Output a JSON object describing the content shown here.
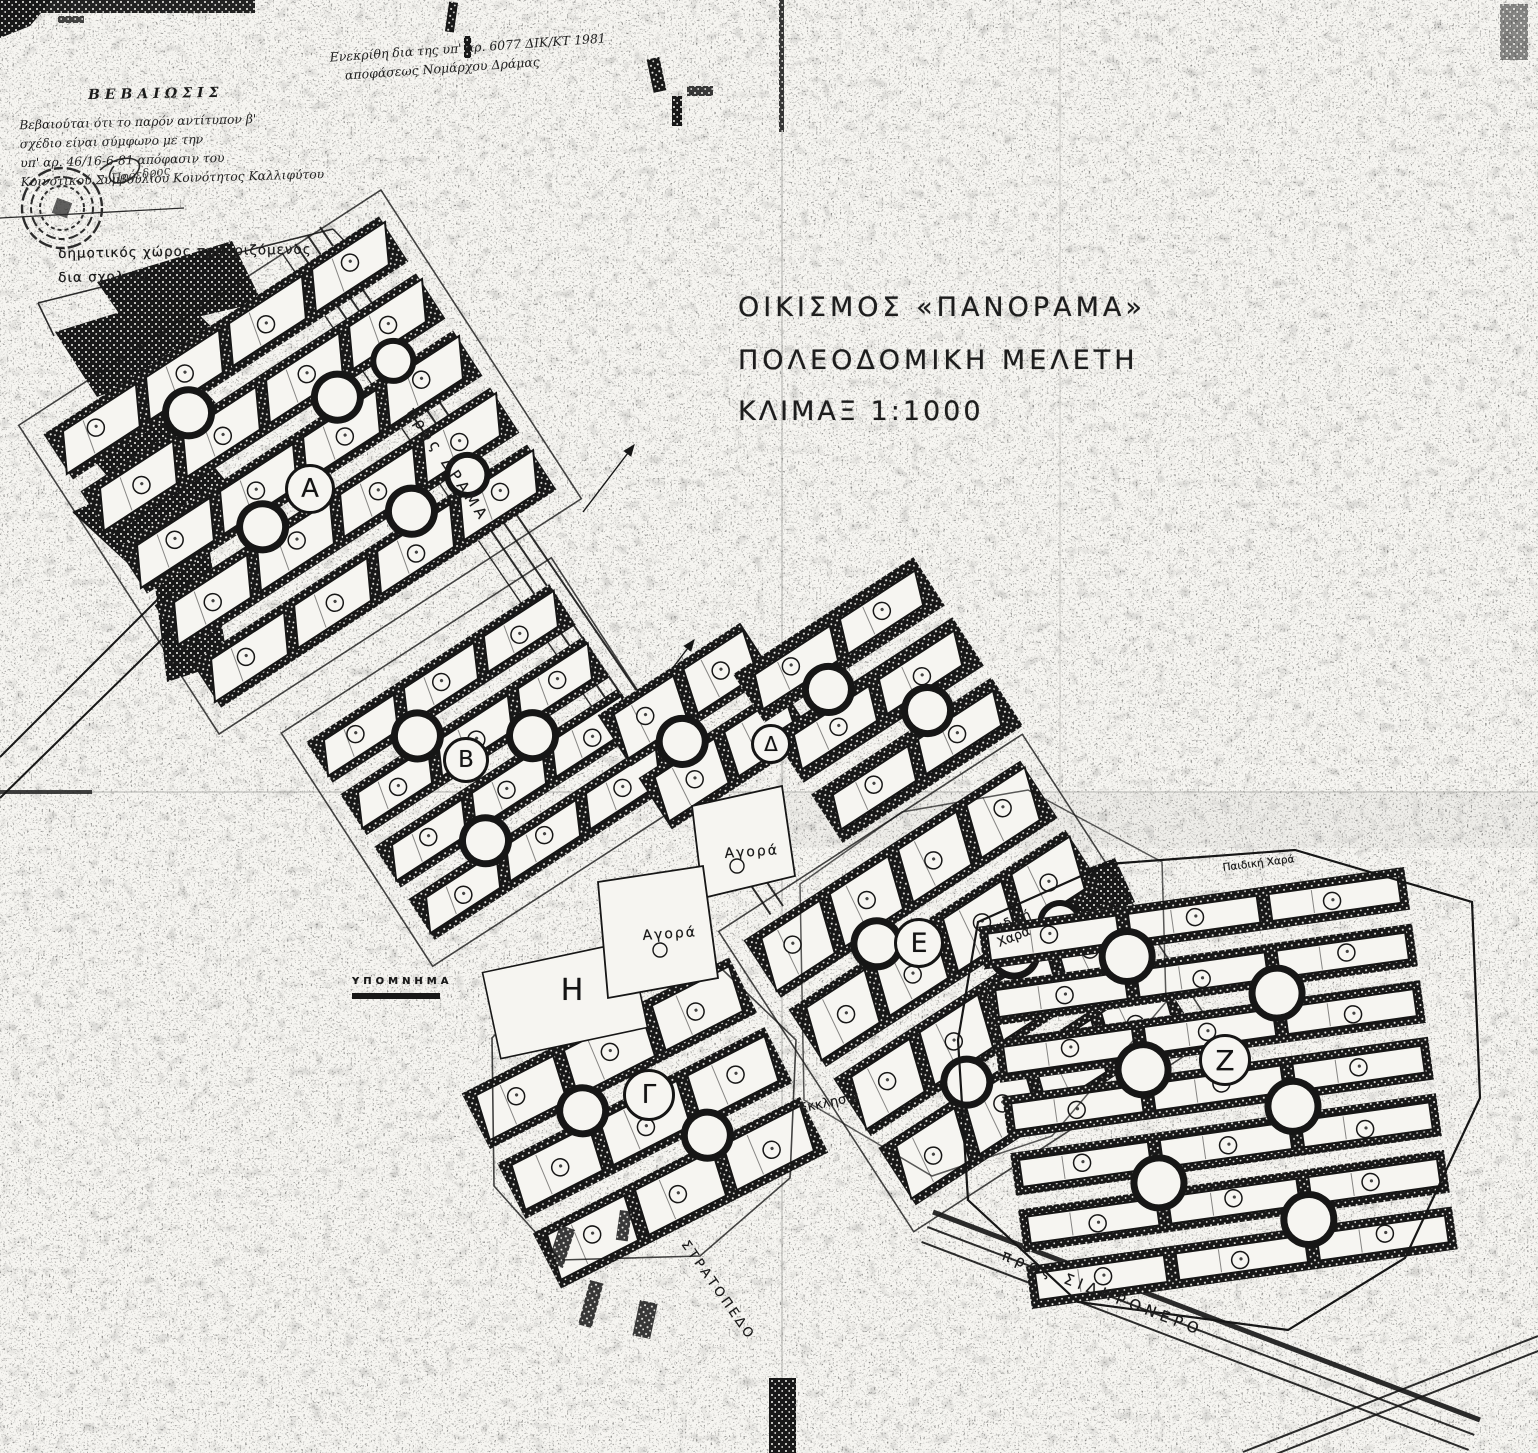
{
  "page": {
    "paper_color": "#f6f5f1",
    "ink_color": "#161616"
  },
  "annotations": {
    "approval_line1": "Ενεκρίθη δια της υπ' αρ. 6077 ΔΙΚ/ΚΤ 1981",
    "approval_line2": "αποφάσεως Νομάρχου Δράμας",
    "certification_title": "ΒΕΒΑΙΩΣΙΣ",
    "certification_lines": [
      "Βεβαιούται ότι το παρόν αντίτυπον β'",
      "σχέδιο είναι σύμφωνο με την",
      "υπ' αρ. 46/16-6-81 απόφασιν του",
      "Κοινοτικού Συμβουλίου Κοινότητος Καλλιφύτου"
    ],
    "signature": "ο Πρόεδρος"
  },
  "title_block": {
    "line1": "ΟΙΚΙΣΜΟΣ «ΠΑΝΟΡΑΜΑ»",
    "line2": "ΠΟΛΕΟΔΟΜΙΚΗ ΜΕΛΕΤΗ",
    "line3": "ΚΛΙΜΑΞ 1:1000"
  },
  "legend": {
    "title": "ΥΠΟΜΝΗΜΑ"
  },
  "labels": {
    "school_note_line1": "δημοτικός χώρος προοριζόμενος",
    "school_note_line2": "δια σχολείο",
    "road_drama": "προς ΔΡΑΜΑ",
    "road_sidironero": "προς ΣΙΔΗΡΟΝΕΡΟ",
    "camp": "ΣΤΡΑΤΟΠΕΔΟ",
    "agora_upper": "Αγορά",
    "agora_lower": "Αγορά",
    "playground_e_line1": "Παιδική",
    "playground_e_line2": "Χαρά",
    "playground_z": "Παιδική Χαρά",
    "church": "Εκκλησία"
  },
  "map": {
    "scale": "1:1000",
    "blocks": [
      {
        "letter": "Α"
      },
      {
        "letter": "Β"
      },
      {
        "letter": "Γ"
      },
      {
        "letter": "Δ"
      },
      {
        "letter": "Ε"
      },
      {
        "letter": "Ζ"
      },
      {
        "letter": "Η"
      }
    ]
  }
}
